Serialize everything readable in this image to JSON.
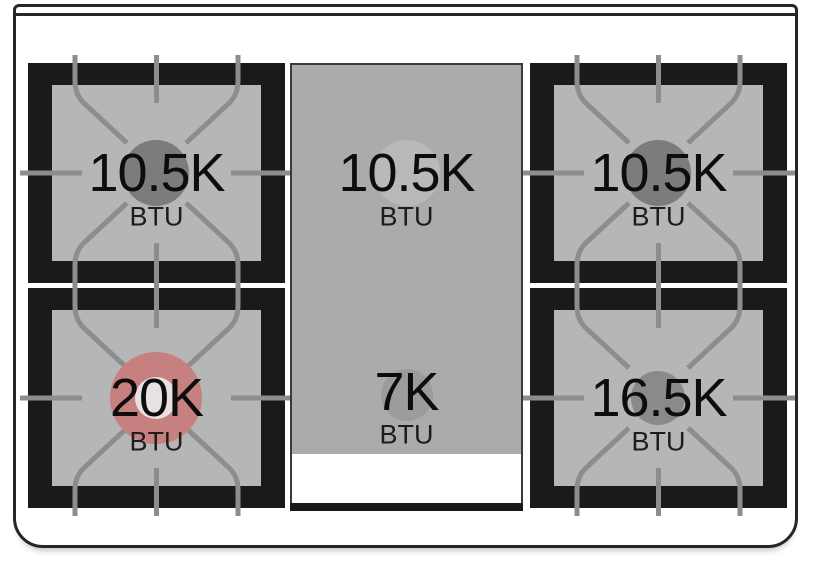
{
  "cooktop": {
    "description_values_unit": "BTU",
    "burners": [
      {
        "position": "back-left",
        "type": "grate-burner",
        "value": "10.5K",
        "unit": "BTU",
        "circle_color": "#7c7c7c"
      },
      {
        "position": "back-center-griddle",
        "type": "griddle-zone",
        "value": "10.5K",
        "unit": "BTU",
        "circle_color": "#b9b9b9"
      },
      {
        "position": "back-right",
        "type": "grate-burner",
        "value": "10.5K",
        "unit": "BTU",
        "circle_color": "#7c7c7c"
      },
      {
        "position": "front-left",
        "type": "grate-burner",
        "value": "20K",
        "unit": "BTU",
        "circle_color": "#c5807f",
        "circle_inner_color": "#e9e1e1",
        "highlighted": true
      },
      {
        "position": "front-center-griddle",
        "type": "griddle-zone",
        "value": "7K",
        "unit": "BTU",
        "circle_color": "#9c9c9c"
      },
      {
        "position": "front-right",
        "type": "grate-burner",
        "value": "16.5K",
        "unit": "BTU",
        "circle_color": "#8a8a8a"
      }
    ],
    "colors": {
      "frame_line": "#262626",
      "grate_black": "#1a1a1a",
      "burner_surface": "#b6b6b6",
      "griddle_surface": "#ababab",
      "grate_line": "#8d8d8d",
      "highlight_red": "#c5807f"
    }
  }
}
